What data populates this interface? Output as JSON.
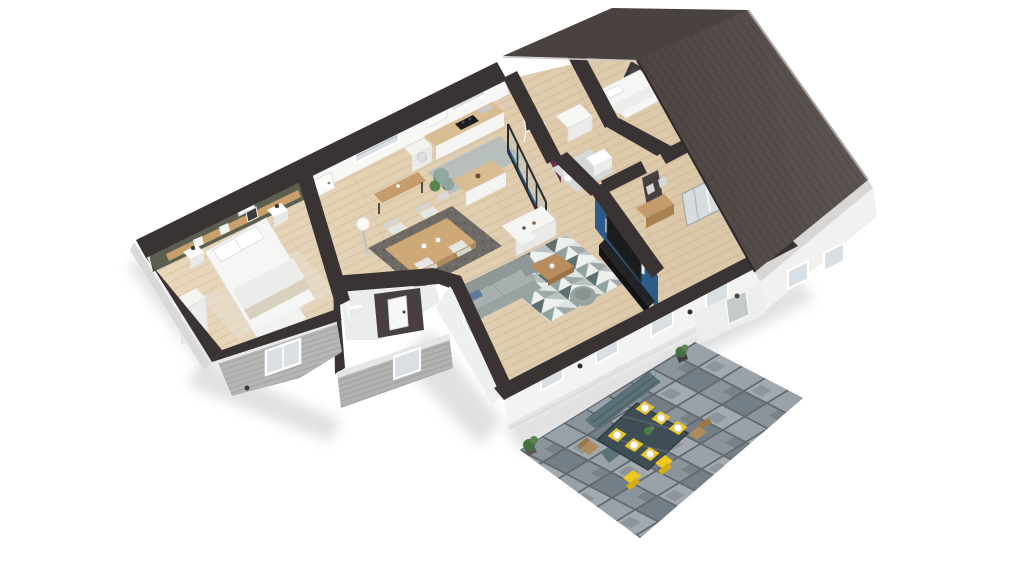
{
  "scene": {
    "description": "3D dollhouse cutaway rendering of a single-story house: furnished rooms seen from above, partially removed dark gabled roof over the right wing, gray stone patio with outdoor dining set at the front",
    "view": "aerial isometric-perspective architectural render",
    "background": "#ffffff"
  },
  "palette": {
    "wall_cap": "#3a3333",
    "wall_white": "#f2f2f1",
    "wall_face_white": "#f7f7f5",
    "wall_shade": "#e6e6e4",
    "roof_flat": "#4a423f",
    "roof_main": "#564e4a",
    "roof_edge": "#2e2928",
    "fascia": "#d8d7d5",
    "siding": "#b5b5b3",
    "siding_trim": "#e8e8e6",
    "floor_light": "#e8d7bb",
    "floor_dark": "#d9c5a5",
    "olive_wall": "#5a5f50",
    "plum_wall": "#6e2c50",
    "blue_wall": "#2d5c8a",
    "dark_accent_wall": "#474043",
    "tile_floor": "#d6d8d9",
    "sofa_gray": "#9aa3a2",
    "sofa_cushion": "#a8b0af",
    "rug_teal": "#5d706f",
    "rug_gray": "#b9c2c1",
    "rug_light": "#eef0ee",
    "dining_rug": "#6e6a66",
    "kitchen_rug": "#a9bac2",
    "wood_mid": "#c49a6c",
    "wood_counter": "#d8bd92",
    "wood_coffee": "#b98d5e",
    "wood_dark": "#9c7848",
    "tv_black": "#1b1c1e",
    "cooktop_black": "#1c1c1e",
    "window_glass": "#d9dfe3",
    "yellow": "#eec81d",
    "yellow_dark": "#d4af12",
    "bench_teal": "#5b7278",
    "patio_table": "#3f4e55",
    "paver_gap": "#5f676f",
    "paver_a": "#8b949b",
    "paver_b": "#9aa2a9",
    "paver_c": "#747e86",
    "paver_d": "#a2a9af",
    "plant_green": "#4e7a46",
    "plant_light": "#588550",
    "bed_white": "#f6f6f4",
    "headboard_dark": "#47474a",
    "shadow": "#bdbdbd"
  },
  "rooms": [
    {
      "id": "master-bedroom",
      "name": "master bedroom",
      "accent_color": "#5a5f50",
      "furniture": [
        "white double bed",
        "wood shelf headboard with frames",
        "two nightstands with lamps",
        "white wardrobe",
        "white bench",
        "beige rug"
      ]
    },
    {
      "id": "entry-dining",
      "name": "entry and dining area",
      "furniture": [
        "white front door",
        "console table",
        "floor lamp",
        "tall potted plant",
        "wood dining table",
        "four light chairs",
        "dark mottled rug"
      ]
    },
    {
      "id": "kitchen",
      "name": "kitchen",
      "furniture": [
        "white cabinets with wood counter",
        "black cooktop",
        "wall window",
        "washing machine",
        "kitchen island",
        "blue-gray rug",
        "black framed glass partition",
        "white sideboard"
      ]
    },
    {
      "id": "kids-room",
      "name": "kids room",
      "accent_color": "#6e2c50",
      "furniture": [
        "easel with chalkboard",
        "white crib dresser"
      ]
    },
    {
      "id": "bathroom",
      "name": "bathroom",
      "furniture": [
        "white vanity",
        "toilet",
        "gray tile floor"
      ]
    },
    {
      "id": "bedroom-2",
      "name": "second bedroom",
      "furniture": [
        "bed with dark curved headboard",
        "white bedding"
      ]
    },
    {
      "id": "entry-hall",
      "name": "entrance hall",
      "furniture": [
        "wood console",
        "wall frames",
        "mirrored sliding wardrobe"
      ]
    },
    {
      "id": "living-room",
      "name": "living room",
      "accent_color": "#2d5c8a",
      "furniture": [
        "gray sofa with blue cushion",
        "geometric triangle rug",
        "wood coffee table",
        "white stool",
        "round gray chair",
        "TV on black console",
        "three wall frames",
        "plant"
      ]
    },
    {
      "id": "mudroom",
      "name": "mudroom",
      "furniture": [
        "white interior door"
      ]
    }
  ],
  "roof": {
    "type": "gable",
    "state": "partially removed cutaway",
    "color": "#564e4a"
  },
  "patio": {
    "name": "stone paver patio",
    "furniture": [
      "dark glass outdoor table",
      "six yellow placemats with white plates",
      "two yellow chairs",
      "two wooden chairs",
      "long teal bench",
      "short teal bench",
      "green shrubs in pots"
    ]
  }
}
